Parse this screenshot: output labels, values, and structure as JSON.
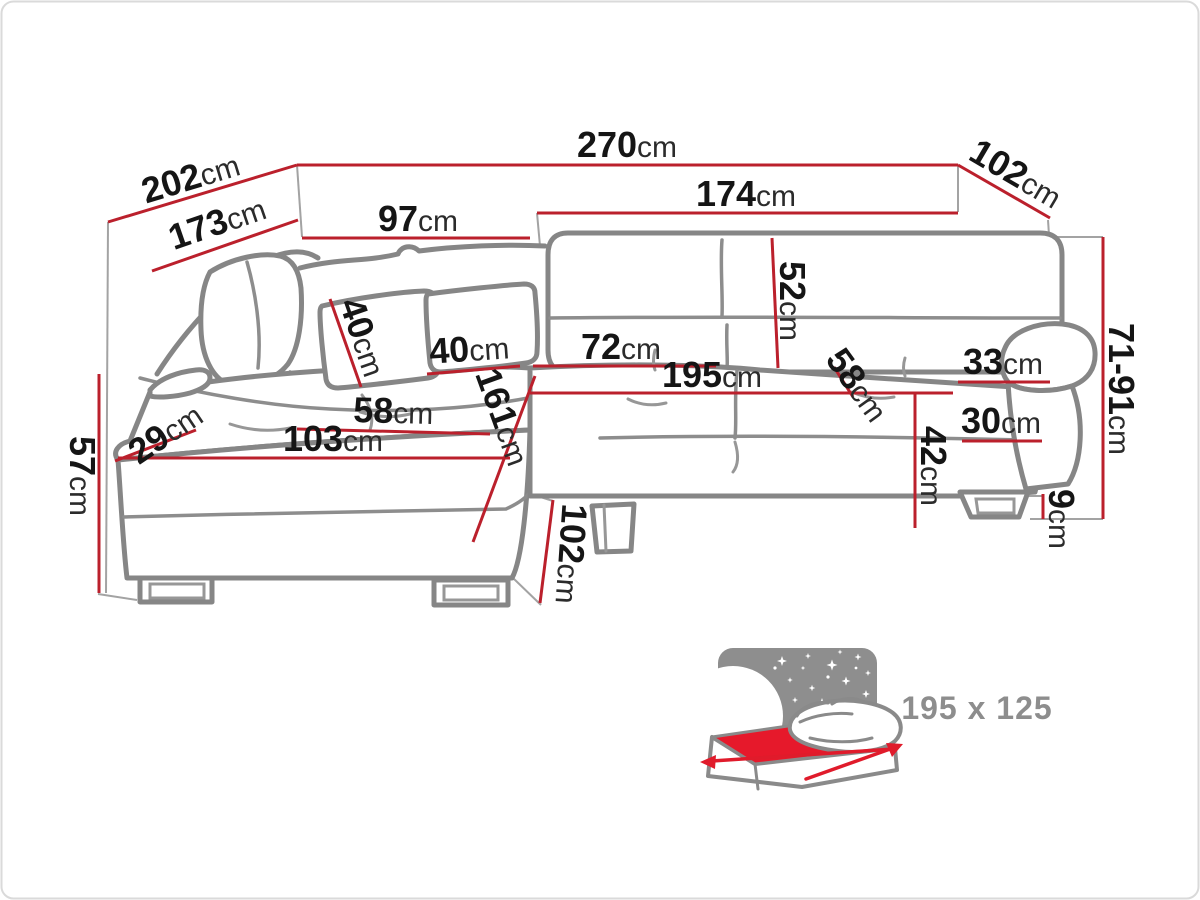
{
  "diagram_title": "corner-sofa-dimension-drawing",
  "colors": {
    "dimension_line": "#bb202c",
    "sofa_outline": "#868686",
    "label_number": "#151515",
    "label_unit": "#2b2b2b",
    "bed_text": "#8d8d8d",
    "mattress_red": "#e6192b",
    "panel_gray": "#8e8e8e",
    "border": "#dadada"
  },
  "dims": {
    "w270": {
      "num": "270",
      "unit": "cm"
    },
    "d202": {
      "num": "202",
      "unit": "cm"
    },
    "d102": {
      "num": "102",
      "unit": "cm"
    },
    "d173": {
      "num": "173",
      "unit": "cm"
    },
    "h97": {
      "num": "97",
      "unit": "cm"
    },
    "h174": {
      "num": "174",
      "unit": "cm"
    },
    "v52": {
      "num": "52",
      "unit": "cm"
    },
    "h72": {
      "num": "72",
      "unit": "cm"
    },
    "h195": {
      "num": "195",
      "unit": "cm"
    },
    "d58r": {
      "num": "58",
      "unit": "cm"
    },
    "h33": {
      "num": "33",
      "unit": "cm"
    },
    "h30": {
      "num": "30",
      "unit": "cm"
    },
    "v42": {
      "num": "42",
      "unit": "cm"
    },
    "v71_91": {
      "num": "71-91",
      "unit": "cm"
    },
    "v9": {
      "num": "9",
      "unit": "cm"
    },
    "h58l": {
      "num": "58",
      "unit": "cm"
    },
    "h103": {
      "num": "103",
      "unit": "cm"
    },
    "d29": {
      "num": "29",
      "unit": "cm"
    },
    "d161": {
      "num": "161",
      "unit": "cm"
    },
    "v57": {
      "num": "57",
      "unit": "cm"
    },
    "v102": {
      "num": "102",
      "unit": "cm"
    },
    "d40a": {
      "num": "40",
      "unit": "cm"
    },
    "d40b": {
      "num": "40",
      "unit": "cm"
    }
  },
  "sleeping_area": {
    "label": "195 x 125"
  }
}
